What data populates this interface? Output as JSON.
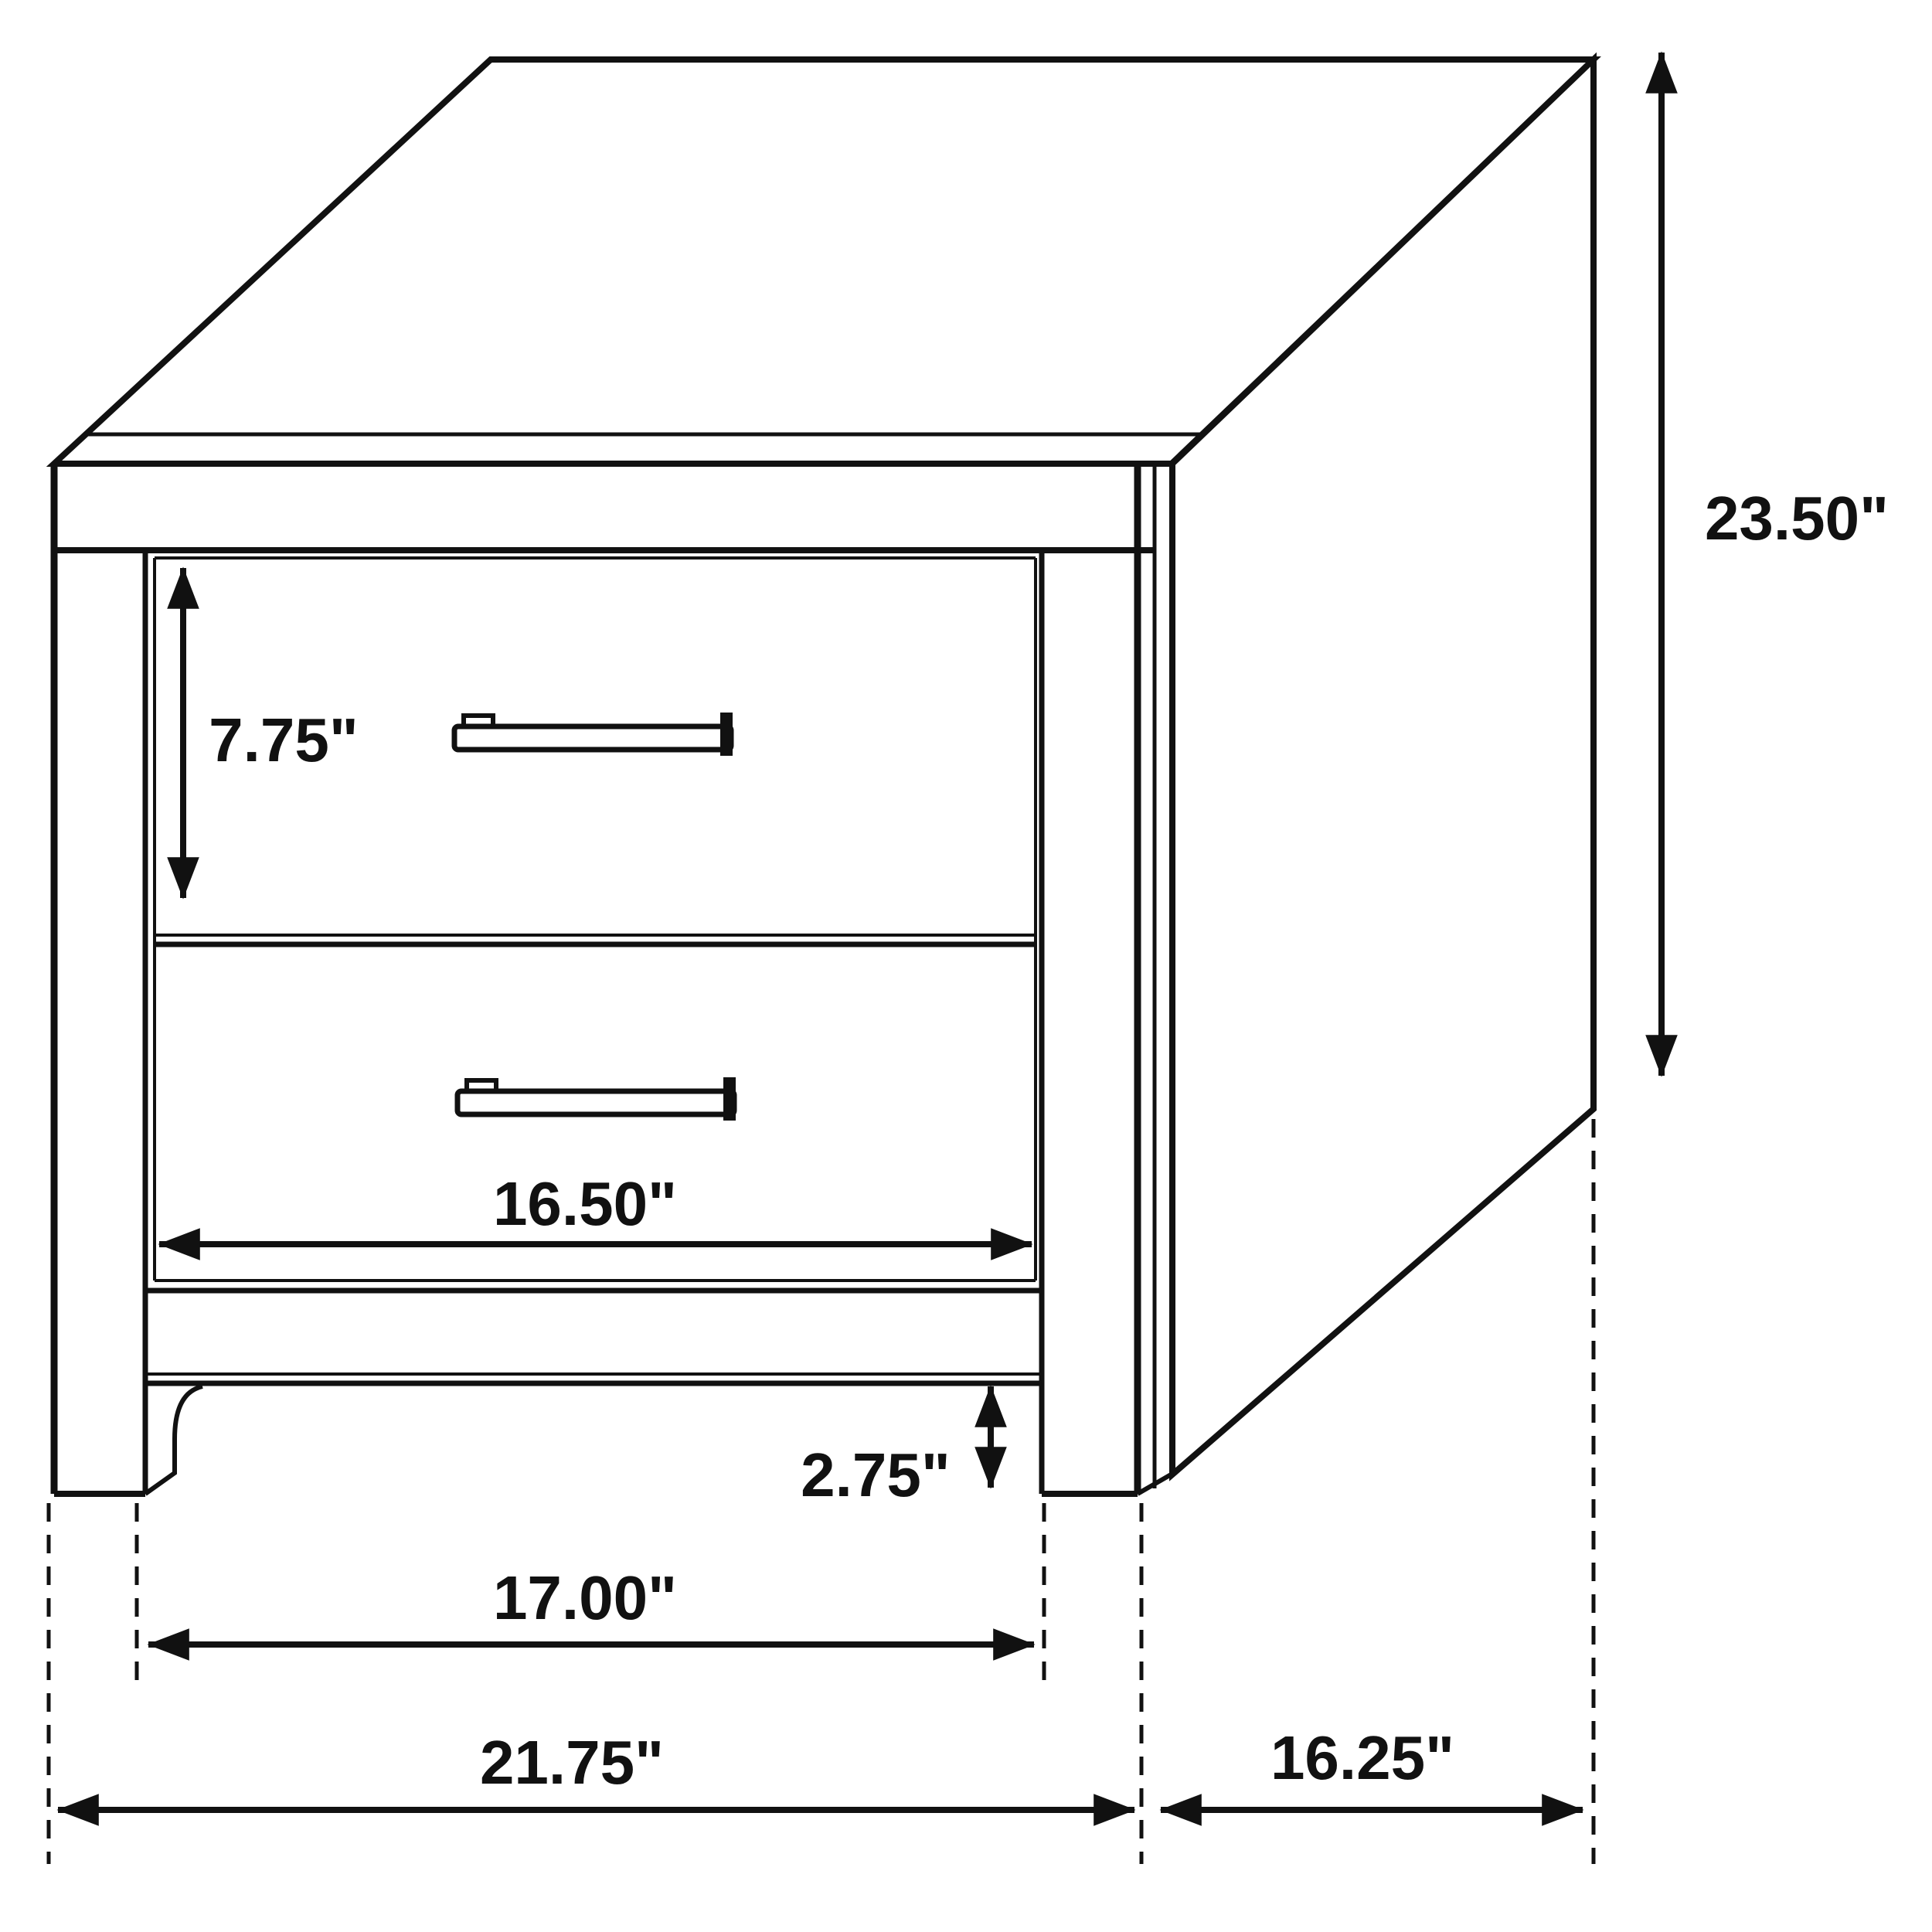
{
  "diagram": {
    "title": "Nightstand dimension drawing",
    "subject": "two-drawer nightstand, isometric line drawing",
    "background_color": "#ffffff",
    "line_color": "#111111",
    "dimensions": {
      "overall_height": "23.50\"",
      "top_drawer_height": "7.75\"",
      "drawer_width": "16.50\"",
      "base_clearance": "2.75\"",
      "leg_span_width": "17.00\"",
      "overall_width": "21.75\"",
      "depth": "16.25\""
    }
  }
}
